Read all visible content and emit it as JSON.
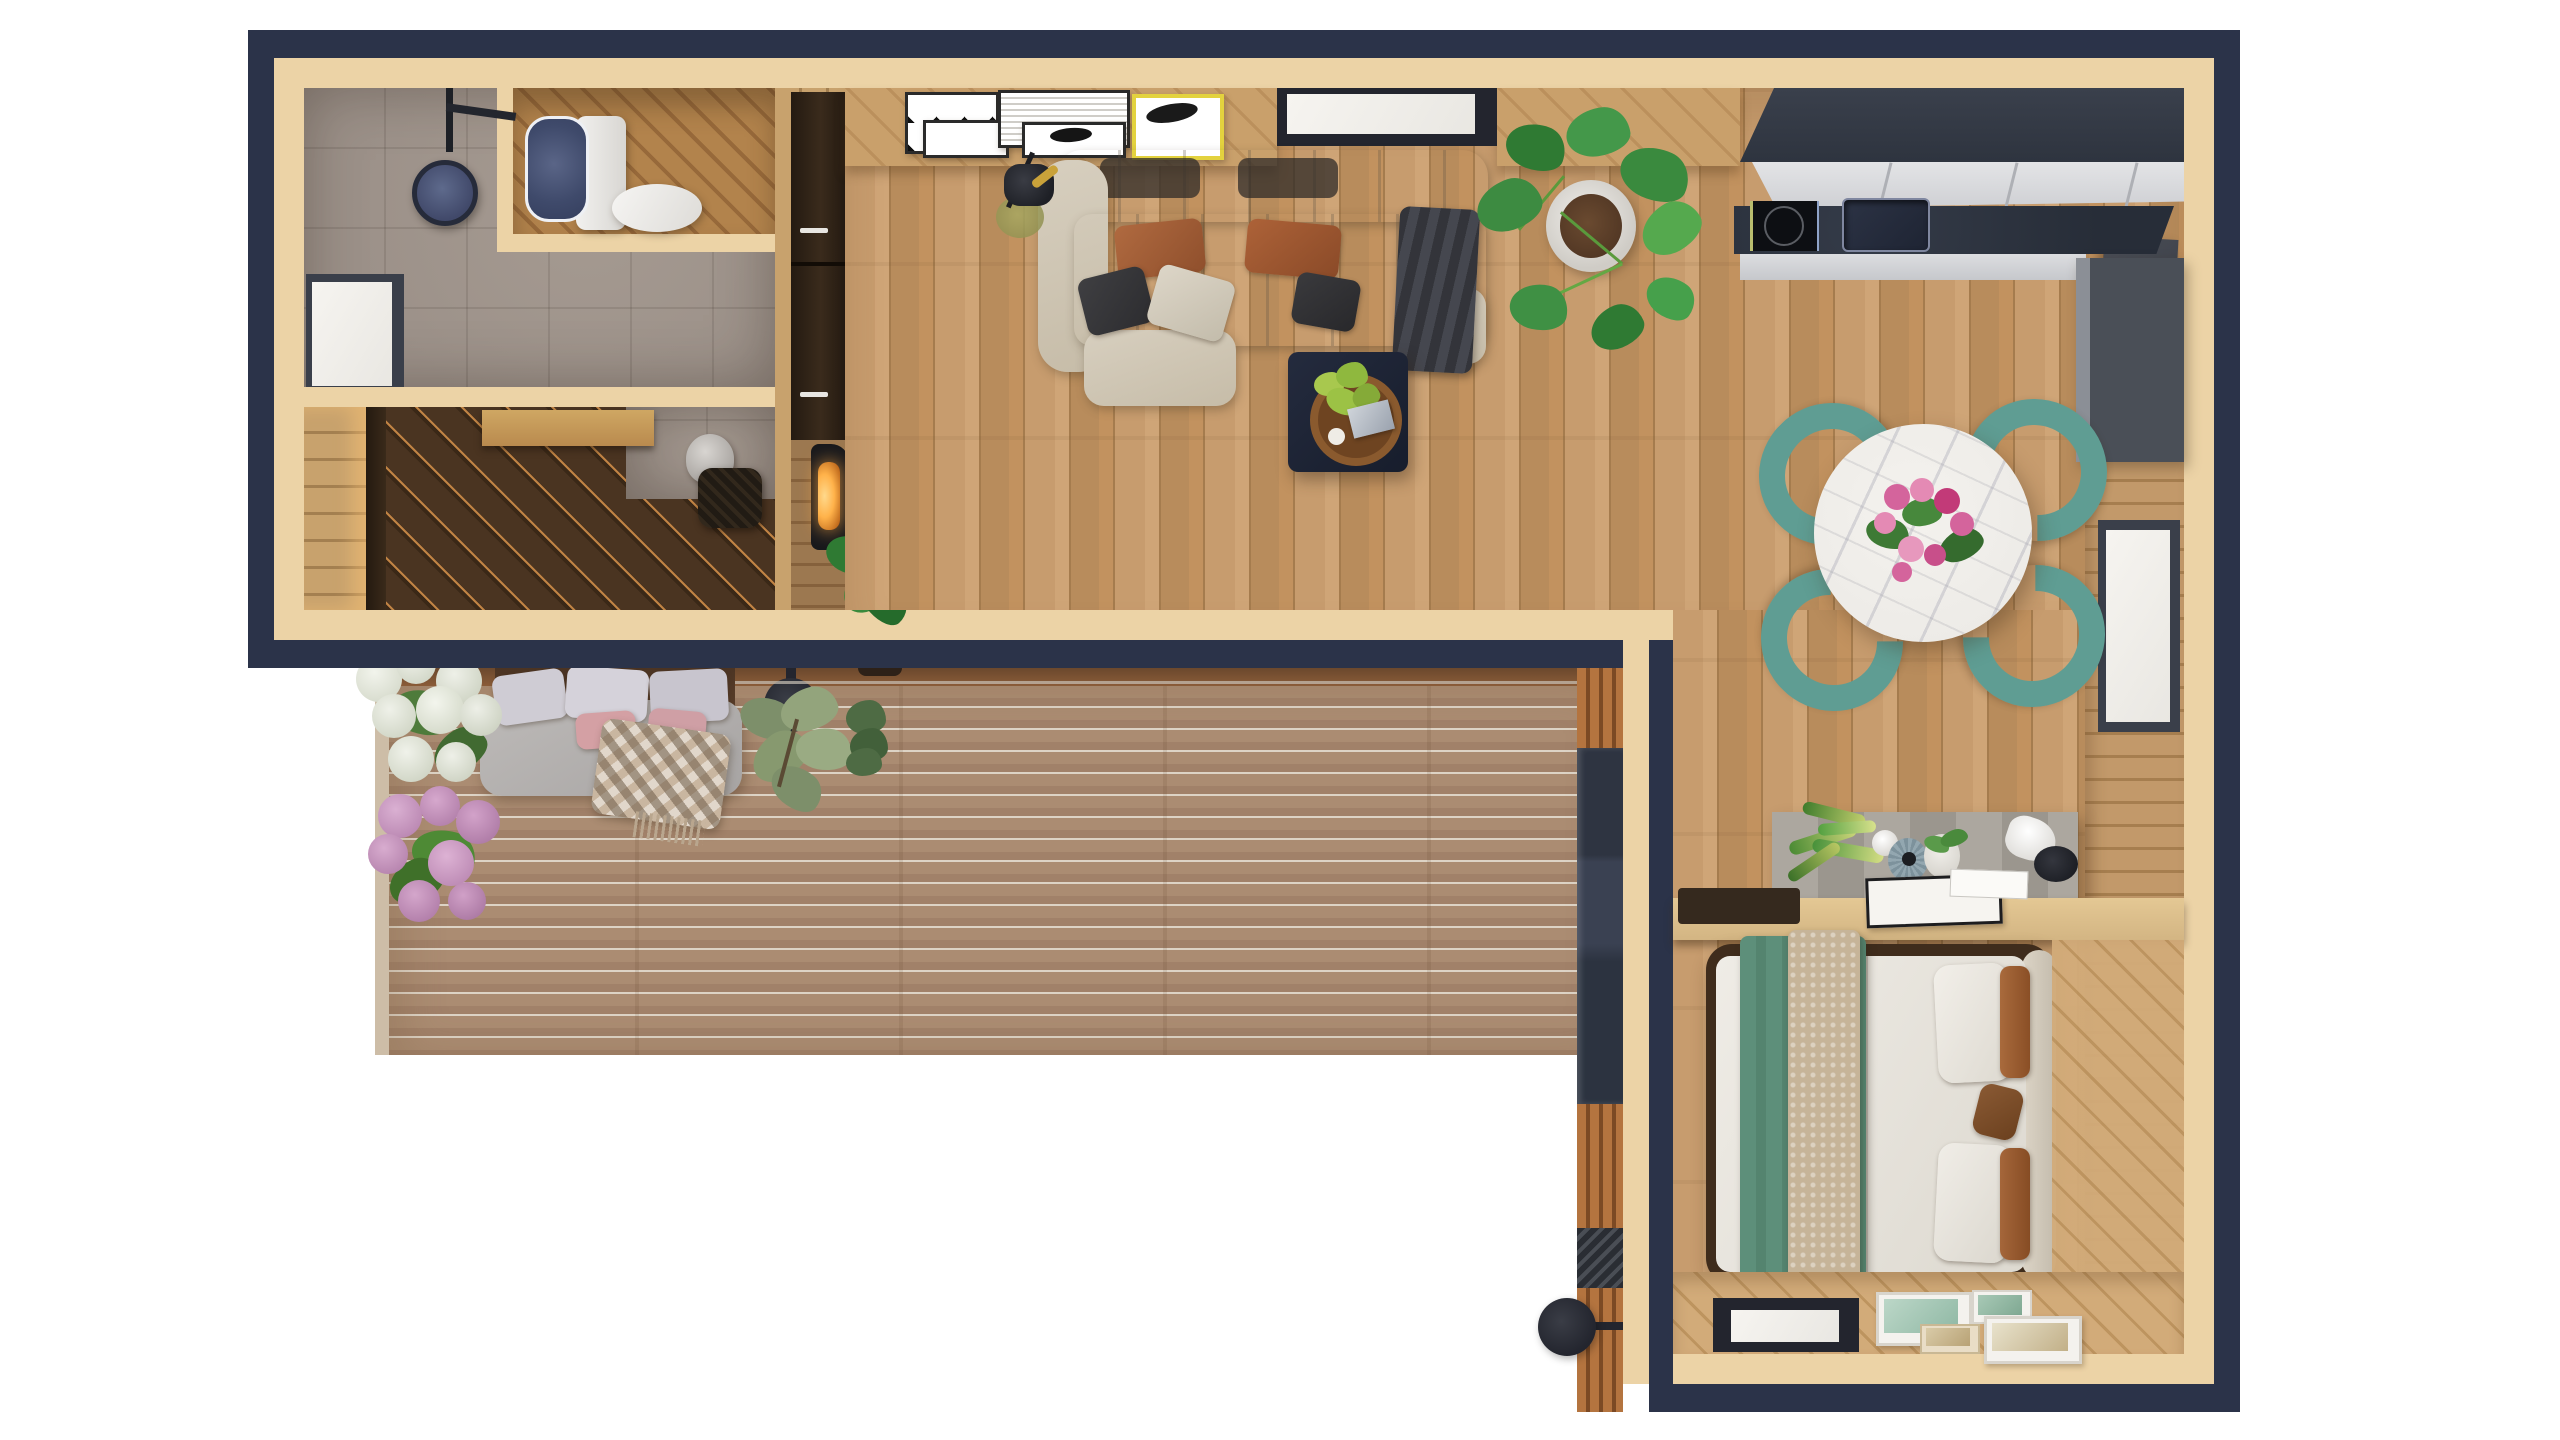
{
  "scene": {
    "type": "top-down-3d-floor-plan-render",
    "background": "#ffffff",
    "text_visible": "none",
    "palette": {
      "outer_wall_navy": "#2b3349",
      "inner_wall_tan": "#ecd3a6",
      "oak_floor": "#c79c6e",
      "deck_board": "#ab8c72",
      "deck_gap": "#ddd3c5",
      "bathroom_stone": "#9c9189",
      "wardrobe_dark_wood": "#47331f",
      "wardrobe_gold_seam": "#c08344",
      "kitchen_cabinet_dark": "#343a45",
      "kitchen_counter_white": "#d9dadd",
      "sofa_cream": "#cec5b3",
      "dining_chair_teal": "#5f9d93",
      "marble_table": "#edebe7",
      "bed_blanket_green": "#5d8f7a",
      "knit_throw": "#c8b89e",
      "accent_rust": "#9c5c32",
      "hydrangea_white": "#e8eae1",
      "hydrangea_pink": "#c793bd",
      "plant_green": "#3e8a3e",
      "fireplace_glow": "#ffb24a",
      "fixture_black": "#23252e"
    }
  },
  "rooms": [
    {
      "id": "bathroom",
      "items": [
        "shower-head",
        "shower-arm",
        "toilet",
        "window",
        "stone-tile-floor",
        "toilet-nook-wood-floor"
      ]
    },
    {
      "id": "entry-closet",
      "items": [
        "dark-wardrobe-floor",
        "sliding-door-panel",
        "lit-plank-strip",
        "vanity-desk",
        "desk-lamp",
        "chair"
      ]
    },
    {
      "id": "living-room",
      "items": [
        "modular-cream-sofa",
        "rust-pillows",
        "gray-pillows",
        "charcoal-throw",
        "coffee-table",
        "wood-tray",
        "bonsai-plant",
        "floor-lamp",
        "console-sideboard",
        "art-posters",
        "top-window",
        "monstera-plant",
        "tall-cabinet",
        "fireplace",
        "fireplace-plant",
        "sliding-door-handle"
      ]
    },
    {
      "id": "kitchen",
      "items": [
        "upper-dark-cabinets",
        "white-counter",
        "induction-cooktop",
        "sink",
        "tall-dark-unit",
        "dark-wall-panel"
      ]
    },
    {
      "id": "dining-area",
      "items": [
        "round-marble-table",
        "flower-bouquet",
        "teal-chair-1",
        "teal-chair-2",
        "teal-chair-3",
        "teal-chair-4",
        "side-window"
      ]
    },
    {
      "id": "workspace",
      "items": [
        "gray-planter-box",
        "snake-plant",
        "sphere-lamp",
        "blue-vase",
        "potted-plant",
        "cone-desk-lamp",
        "desk-counter",
        "notebook",
        "card",
        "dark-tray"
      ]
    },
    {
      "id": "bedroom",
      "items": [
        "double-bed",
        "headboard-bolster",
        "green-blanket",
        "knit-throw",
        "white-pillows",
        "rust-bolsters",
        "walkway-strip",
        "floor-window",
        "art-prints"
      ]
    },
    {
      "id": "deck",
      "items": [
        "deck-boards",
        "outdoor-sofa",
        "gray-cushion",
        "lavender-pillows",
        "pink-pillows",
        "checker-throw",
        "white-hydrangea",
        "pink-hydrangea",
        "olive-shrub",
        "small-shrub",
        "wall-sconce",
        "porch-lamp",
        "porch-glass-door",
        "porch-vent"
      ]
    }
  ],
  "counts": {
    "dining_chairs": 4,
    "bed_white_pillows": 2,
    "bed_rust_bolsters": 2,
    "deck_sofa_pillows": 5,
    "bedroom_art_prints": 4,
    "living_posters": 5,
    "windows_visible": 5
  }
}
